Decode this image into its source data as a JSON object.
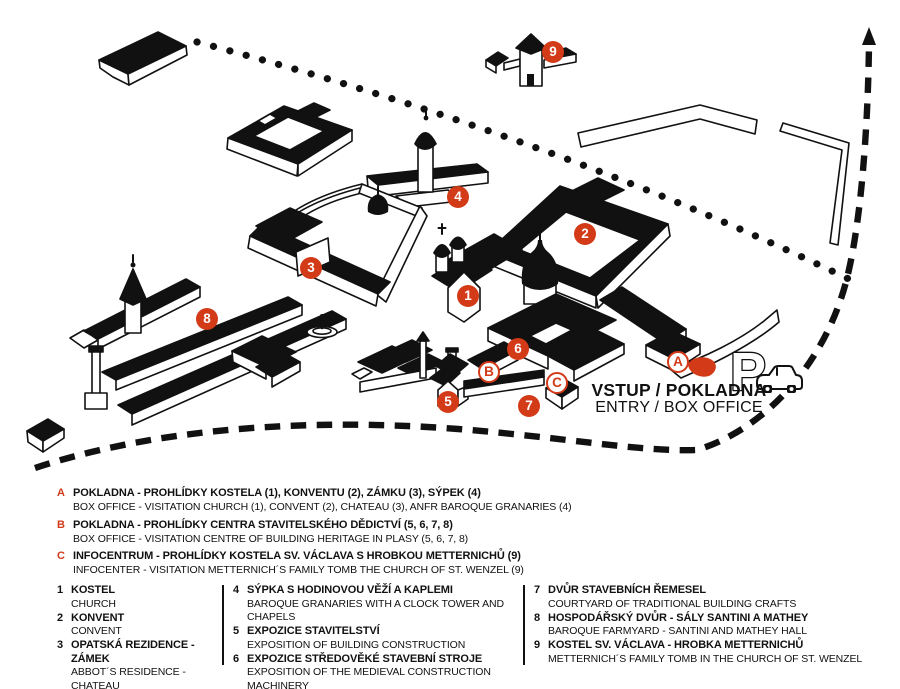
{
  "colors": {
    "accent": "#d23a18",
    "ink": "#111111",
    "paper": "#ffffff"
  },
  "map": {
    "entry_label_line1": "VSTUP / POKLADNA",
    "entry_label_line2": "ENTRY / BOX OFFICE",
    "parking_symbol": "P",
    "markers": [
      {
        "id": "1",
        "type": "number",
        "x": 468,
        "y": 296
      },
      {
        "id": "2",
        "type": "number",
        "x": 585,
        "y": 234
      },
      {
        "id": "3",
        "type": "number",
        "x": 311,
        "y": 268
      },
      {
        "id": "4",
        "type": "number",
        "x": 458,
        "y": 197
      },
      {
        "id": "5",
        "type": "number",
        "x": 448,
        "y": 402
      },
      {
        "id": "6",
        "type": "number",
        "x": 518,
        "y": 349
      },
      {
        "id": "7",
        "type": "number",
        "x": 529,
        "y": 406
      },
      {
        "id": "8",
        "type": "number",
        "x": 207,
        "y": 319
      },
      {
        "id": "9",
        "type": "number",
        "x": 553,
        "y": 52
      },
      {
        "id": "A",
        "type": "letter",
        "x": 678,
        "y": 362
      },
      {
        "id": "B",
        "type": "letter",
        "x": 489,
        "y": 372
      },
      {
        "id": "C",
        "type": "letter",
        "x": 557,
        "y": 383
      }
    ]
  },
  "legend_services": [
    {
      "id": "A",
      "cs": "POKLADNA - PROHLÍDKY KOSTELA (1), KONVENTU (2), ZÁMKU (3), SÝPEK (4)",
      "en": "BOX OFFICE - VISITATION CHURCH (1), CONVENT (2), CHATEAU (3), ANFR BAROQUE GRANARIES (4)"
    },
    {
      "id": "B",
      "cs": "POKLADNA - PROHLÍDKY CENTRA STAVITELSKÉHO DĚDICTVÍ (5, 6, 7, 8)",
      "en": "BOX OFFICE - VISITATION CENTRE OF BUILDING HERITAGE IN PLASY (5, 6, 7, 8)"
    },
    {
      "id": "C",
      "cs": "INFOCENTRUM - PROHLÍDKY KOSTELA SV. VÁCLAVA S HROBKOU METTERNICHŮ (9)",
      "en": "INFOCENTER - VISITATION METTERNICH´S FAMILY TOMB THE CHURCH OF ST. WENZEL (9)"
    }
  ],
  "legend_buildings": {
    "col1": [
      {
        "num": "1",
        "cs": "KOSTEL",
        "en": "CHURCH"
      },
      {
        "num": "2",
        "cs": "KONVENT",
        "en": "CONVENT"
      },
      {
        "num": "3",
        "cs": "OPATSKÁ REZIDENCE - ZÁMEK",
        "en": "ABBOT´S RESIDENCE - CHATEAU"
      }
    ],
    "col2": [
      {
        "num": "4",
        "cs": "SÝPKA S HODINOVOU VĚŽÍ A KAPLEMI",
        "en": "BAROQUE GRANARIES WITH A CLOCK TOWER AND CHAPELS"
      },
      {
        "num": "5",
        "cs": "EXPOZICE STAVITELSTVÍ",
        "en": "EXPOSITION OF BUILDING CONSTRUCTION"
      },
      {
        "num": "6",
        "cs": "EXPOZICE STŘEDOVĚKÉ STAVEBNÍ STROJE",
        "en": "EXPOSITION OF THE MEDIEVAL CONSTRUCTION MACHINERY"
      }
    ],
    "col3": [
      {
        "num": "7",
        "cs": "DVŮR STAVEBNÍCH ŘEMESEL",
        "en": "COURTYARD OF TRADITIONAL BUILDING CRAFTS"
      },
      {
        "num": "8",
        "cs": "HOSPODÁŘSKÝ DVŮR - SÁLY SANTINI A MATHEY",
        "en": "BAROQUE FARMYARD - SANTINI AND MATHEY HALL"
      },
      {
        "num": "9",
        "cs": "KOSTEL SV. VÁCLAVA - HROBKA METTERNICHŮ",
        "en": "METTERNICH´S FAMILY TOMB IN THE CHURCH OF ST. WENZEL"
      }
    ]
  }
}
